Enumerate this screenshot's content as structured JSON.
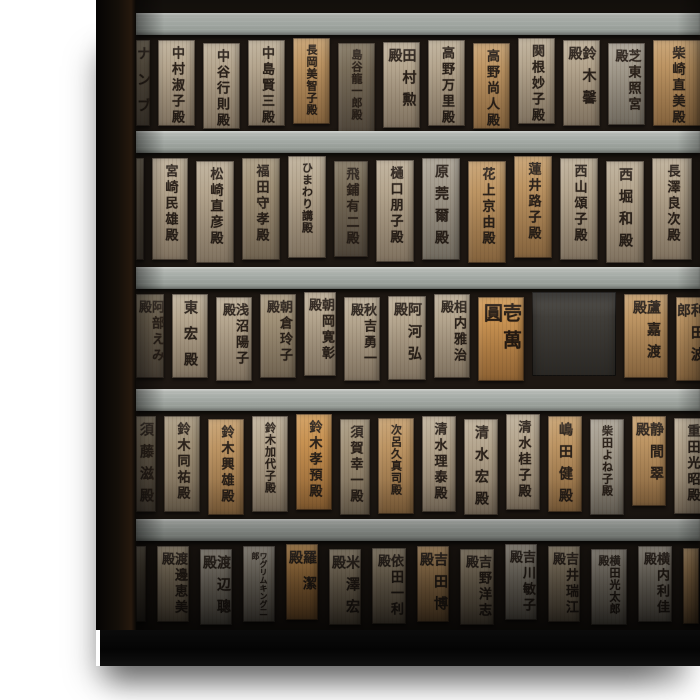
{
  "meta": {
    "subject": "Canvas print photograph of Japanese wooden donor name plaques hanging in rows on a shrine wall"
  },
  "palette": {
    "page_background": "#ffffff",
    "beam_gray": "#a3a9a4",
    "wall_background": "#1d1712",
    "ink": "#2a211a",
    "canvas_side_edge": "#140f09",
    "bottom_shadow_band": "#060606",
    "tones": {
      "light": "#b2a28a",
      "warm": "#bd9160",
      "orange": "#c48b4c",
      "muted": "#9f907b",
      "gray": "#a59d90",
      "dark": "#796e5f",
      "slate": "#3e3c38"
    }
  },
  "wall": {
    "rows": [
      {
        "h": 96,
        "ph": 86,
        "gap": 8,
        "plaques": [
          {
            "text": "ナンブ",
            "tone": "dark",
            "w": 14,
            "kind": "partial-plaque"
          },
          {
            "text": "中村淑子殿",
            "tone": "light",
            "w": 37
          },
          {
            "text": "中谷行則殿",
            "tone": "light",
            "w": 37
          },
          {
            "text": "中島賢三殿",
            "tone": "light",
            "w": 37
          },
          {
            "text": "長岡美智子殿",
            "tone": "warm",
            "w": 37
          },
          {
            "text": "島谷龍一郎殿",
            "tone": "dark",
            "w": 37,
            "h": 90
          },
          {
            "text": "田村勲殿",
            "tone": "light",
            "w": 37
          },
          {
            "text": "高野万里殿",
            "tone": "light",
            "w": 37
          },
          {
            "text": "高野尚人殿",
            "tone": "warm",
            "w": 37
          },
          {
            "text": "関根妙子殿",
            "tone": "light",
            "w": 37
          },
          {
            "text": "鈴木馨殿",
            "tone": "light",
            "w": 37
          },
          {
            "text": "芝東照宮殿",
            "tone": "gray",
            "w": 37,
            "h": 82
          },
          {
            "text": "柴崎直美殿",
            "tone": "warm",
            "w": 48,
            "kind": "partial-plaque"
          }
        ]
      },
      {
        "h": 114,
        "ph": 102,
        "gap": 8,
        "plaques": [
          {
            "text": "",
            "tone": "dark",
            "w": 8,
            "kind": "partial-plaque"
          },
          {
            "text": "宮崎民雄殿",
            "tone": "light",
            "w": 36
          },
          {
            "text": "松崎直彦殿",
            "tone": "light",
            "w": 38
          },
          {
            "text": "福田守孝殿",
            "tone": "muted",
            "w": 38
          },
          {
            "text": "ひまわり講殿",
            "tone": "light",
            "w": 38
          },
          {
            "text": "飛鋪有二殿",
            "tone": "dark",
            "w": 34,
            "h": 96
          },
          {
            "text": "樋口朋子殿",
            "tone": "light",
            "w": 38
          },
          {
            "text": "原莞爾殿",
            "tone": "gray",
            "w": 38
          },
          {
            "text": "花上京由殿",
            "tone": "warm",
            "w": 38
          },
          {
            "text": "蓮井路子殿",
            "tone": "warm",
            "w": 38
          },
          {
            "text": "西山頌子殿",
            "tone": "light",
            "w": 38
          },
          {
            "text": "西堀和殿",
            "tone": "light",
            "w": 38
          },
          {
            "text": "長澤良次殿",
            "tone": "light",
            "w": 40
          }
        ]
      },
      {
        "h": 100,
        "ph": 84,
        "gap": 8,
        "plaques": [
          {
            "text": "阿部えみ殿",
            "tone": "dark",
            "w": 28,
            "kind": "partial-plaque"
          },
          {
            "text": "東宏殿",
            "tone": "light",
            "w": 36
          },
          {
            "text": "浅沼陽子殿",
            "tone": "light",
            "w": 36
          },
          {
            "text": "朝倉玲子殿",
            "tone": "muted",
            "w": 36
          },
          {
            "text": "朝岡寛彰殿",
            "tone": "light",
            "w": 32
          },
          {
            "text": "秋吉勇一殿",
            "tone": "light",
            "w": 36
          },
          {
            "text": "阿河弘殿",
            "tone": "light",
            "w": 38
          },
          {
            "text": "相内雅治殿",
            "tone": "light",
            "w": 36
          },
          {
            "text": "壱萬圓",
            "tone": "orange",
            "w": 46,
            "kind": "price-plaque"
          },
          {
            "text": "",
            "tone": "slate",
            "w": 84,
            "kind": "empty-slate-panel"
          },
          {
            "text": "蘆嘉渡殿",
            "tone": "warm",
            "w": 44
          },
          {
            "text": "利田波郎",
            "tone": "warm",
            "w": 28,
            "kind": "partial-plaque"
          }
        ]
      },
      {
        "h": 108,
        "ph": 96,
        "gap": 8,
        "plaques": [
          {
            "text": "須藤滋殿",
            "tone": "dark",
            "w": 20,
            "kind": "partial-plaque"
          },
          {
            "text": "鈴木同祐殿",
            "tone": "muted",
            "w": 36
          },
          {
            "text": "鈴木興雄殿",
            "tone": "warm",
            "w": 36
          },
          {
            "text": "鈴木加代子殿",
            "tone": "light",
            "w": 36
          },
          {
            "text": "鈴木孝預殿",
            "tone": "orange",
            "w": 36
          },
          {
            "text": "須賀幸一殿",
            "tone": "muted",
            "w": 30
          },
          {
            "text": "次呂久真司殿",
            "tone": "warm",
            "w": 36
          },
          {
            "text": "清水理泰殿",
            "tone": "light",
            "w": 34
          },
          {
            "text": "清水宏殿",
            "tone": "light",
            "w": 34
          },
          {
            "text": "清水桂子殿",
            "tone": "light",
            "w": 34
          },
          {
            "text": "嶋田健殿",
            "tone": "warm",
            "w": 34
          },
          {
            "text": "柴田よね子殿",
            "tone": "gray",
            "w": 34
          },
          {
            "text": "静間翠殿",
            "tone": "warm",
            "w": 34,
            "h": 90
          },
          {
            "text": "重田光昭殿",
            "tone": "light",
            "w": 36
          }
        ]
      },
      {
        "h": 86,
        "ph": 76,
        "gap": 11,
        "plaques": [
          {
            "text": "",
            "tone": "dark",
            "w": 10,
            "kind": "partial-plaque"
          },
          {
            "text": "渡邊恵美殿",
            "tone": "muted",
            "w": 32
          },
          {
            "text": "渡辺聰殿",
            "tone": "gray",
            "w": 32
          },
          {
            "text": "ワグリムキング二郎",
            "tone": "gray",
            "w": 32
          },
          {
            "text": "羅潔殿",
            "tone": "orange",
            "w": 32
          },
          {
            "text": "米澤宏殿",
            "tone": "muted",
            "w": 32
          },
          {
            "text": "依田一利殿",
            "tone": "muted",
            "w": 34
          },
          {
            "text": "吉田博殿",
            "tone": "warm",
            "w": 32
          },
          {
            "text": "吉野洋志殿",
            "tone": "muted",
            "w": 34
          },
          {
            "text": "吉川敏子殿",
            "tone": "gray",
            "w": 32
          },
          {
            "text": "吉井瑞江殿",
            "tone": "muted",
            "w": 32
          },
          {
            "text": "横田光太郎殿",
            "tone": "gray",
            "w": 36
          },
          {
            "text": "横内利佳殿",
            "tone": "gray",
            "w": 34
          },
          {
            "text": "",
            "tone": "warm",
            "w": 16,
            "kind": "partial-plaque"
          }
        ]
      }
    ]
  }
}
